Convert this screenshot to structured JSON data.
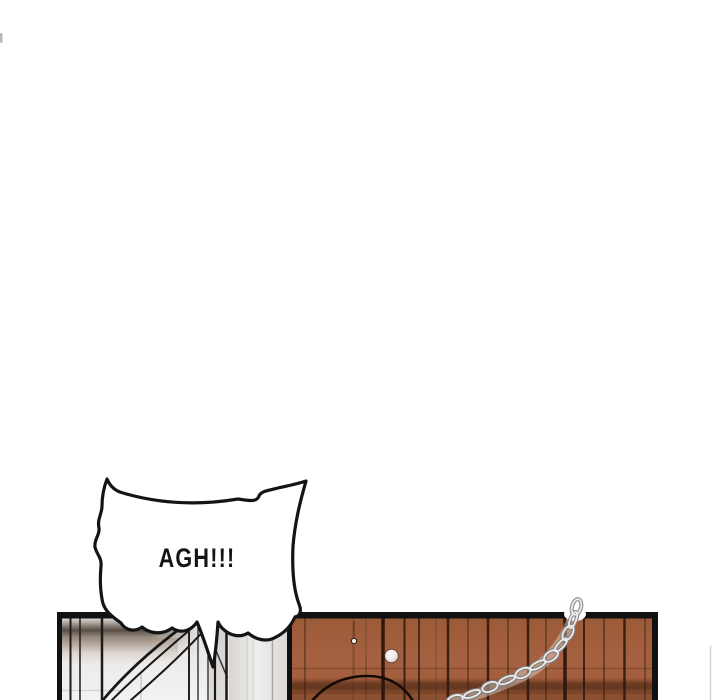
{
  "page": {
    "kind": "comic-strip-panel",
    "background_color": "#ffffff"
  },
  "speech_bubble": {
    "text": "AGH!!!",
    "fill_color": "#ffffff",
    "outline_color": "#141414",
    "text_color": "#141414"
  },
  "panel": {
    "outline_color": "#111111",
    "left_wall_color": "#e9e7e5",
    "left_wall_shadow_color": "#46392d",
    "wood_wall_color": "#a26040",
    "wood_dark_band_color": "#4a2612",
    "plank_line_color": "#2a160c",
    "chain_color": "#d6d6d6",
    "chain_shadow_color": "#7d7d7d",
    "knob_color": "#ffffff"
  }
}
